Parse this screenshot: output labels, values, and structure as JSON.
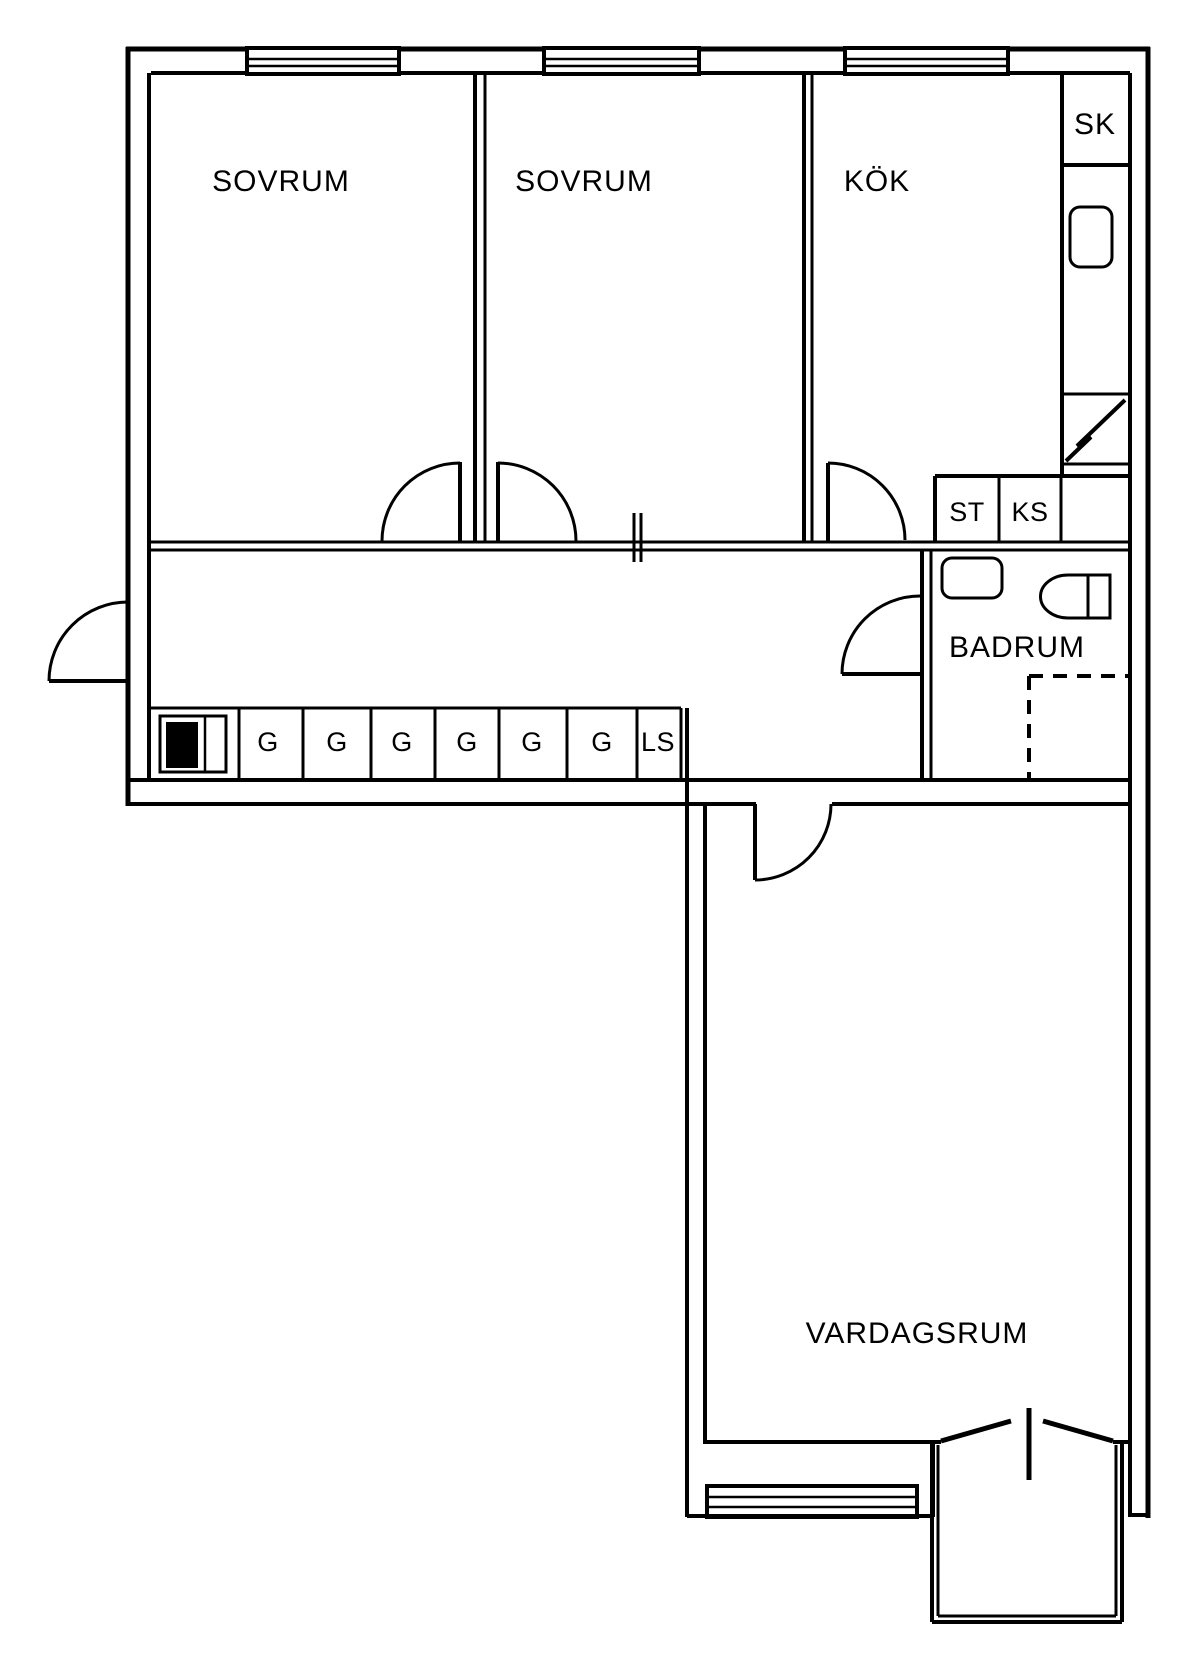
{
  "labels": {
    "sovrum_1": "SOVRUM",
    "sovrum_2": "SOVRUM",
    "kok": "KÖK",
    "sk": "SK",
    "st": "ST",
    "ks": "KS",
    "badrum": "BADRUM",
    "vardagsrum": "VARDAGSRUM",
    "garderober": [
      "G",
      "G",
      "G",
      "G",
      "G",
      "G"
    ],
    "ls": "LS"
  },
  "colors": {
    "line": "#000000",
    "background": "#ffffff"
  }
}
